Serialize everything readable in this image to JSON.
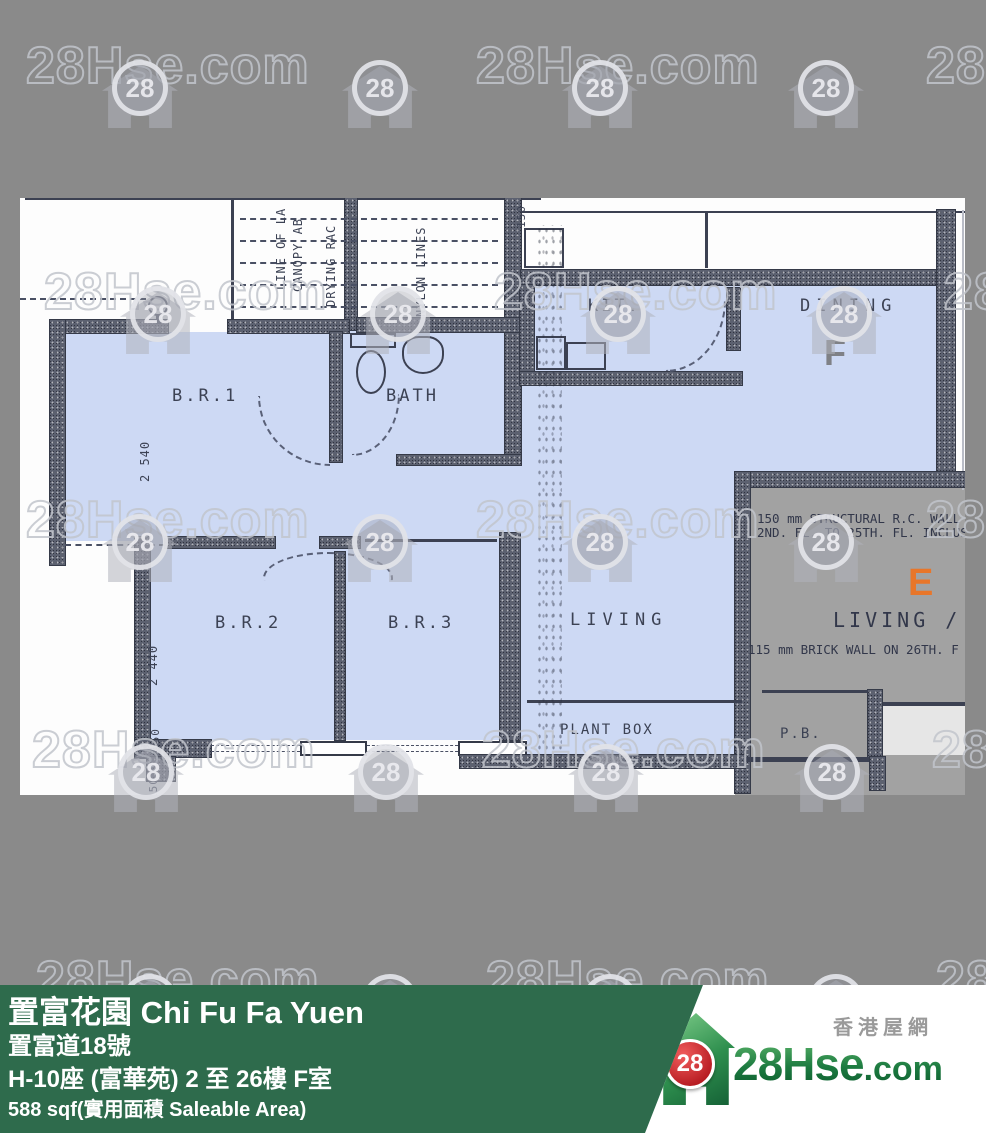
{
  "watermark": {
    "brand": "28Hse.com",
    "badge": "28"
  },
  "plan": {
    "rooms": {
      "br1": "B.R.1",
      "bath": "BATH",
      "kit": "KIT.",
      "dining": "DINING",
      "br2": "B.R.2",
      "br3": "B.R.3",
      "living": "LIVING",
      "plant_box": "PLANT BOX",
      "pb": "P.B."
    },
    "unit_labels": {
      "f": "F",
      "e": "E"
    },
    "annotations": {
      "line_of": "LINE OF LA",
      "canopy": "CANOPY AB",
      "drying_rack": "DRYING RAC",
      "nylon_lines": "NYLON LINES"
    },
    "dimensions": {
      "br1_width": "2 540",
      "br2_width": "2 440",
      "wall_pair": "150 150",
      "wall_a": "150",
      "wall_b": "150",
      "wall_top": "150"
    },
    "notes": {
      "structural_1": "150 mm STRUCTURAL R.C. WALL F",
      "structural_2": "2ND. FL. TO 25TH. FL. INCLUSIVE",
      "living_d": "LIVING / D",
      "brick": "115 mm BRICK WALL ON 26TH. F"
    }
  },
  "banner": {
    "title": "置富花園 Chi Fu Fa Yuen",
    "address": "置富道18號",
    "block": "H-10座 (富華苑) 2 至 26樓 F室",
    "area": "588 sqf(實用面積 Saleable Area)"
  },
  "logo": {
    "badge": "28",
    "brand_main": "28Hse",
    "brand_suffix": ".com",
    "tagline": "香港屋網"
  },
  "colors": {
    "background_gray": "#8a8a8a",
    "highlight_blue": "#cdd9f4",
    "other_unit_gray": "#a2a2a2",
    "banner_green": "#2e6b4c",
    "unit_e_orange": "#e8762a",
    "logo_red": "#c42026",
    "logo_green": "#1d7b41",
    "ink": "#3c4152"
  }
}
